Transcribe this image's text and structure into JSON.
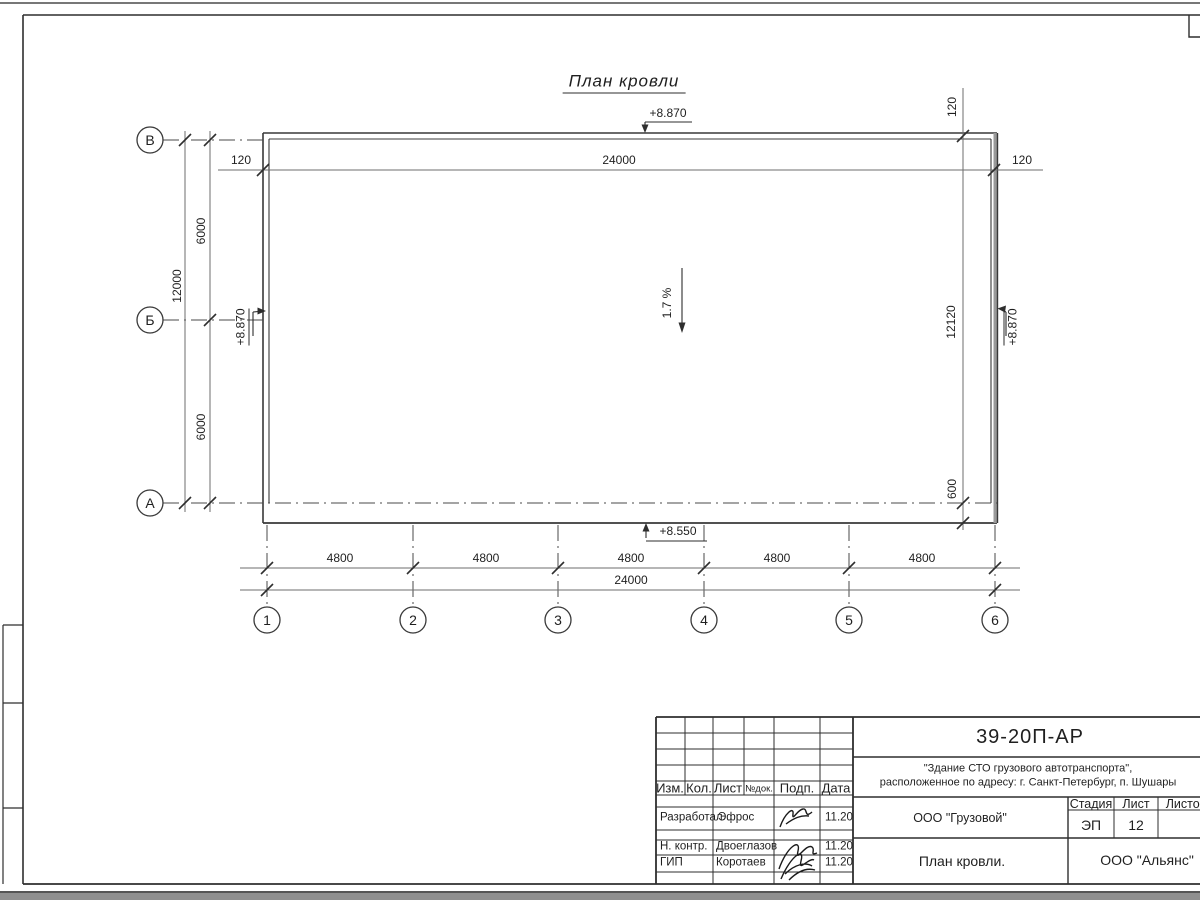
{
  "drawing": {
    "title": "План кровли",
    "slope": "1.7 %",
    "elevations": {
      "top": "+8.870",
      "left": "+8.870",
      "right": "+8.870",
      "bottom": "+8.550"
    },
    "dimensions": {
      "top_offset_left": "120",
      "top_total": "24000",
      "top_offset_right": "120",
      "top_right_vertical": "120",
      "left_span_upper": "6000",
      "left_span_lower": "6000",
      "left_total": "12000",
      "right_total": "12120",
      "right_overhang": "600",
      "bottom_segments": [
        "4800",
        "4800",
        "4800",
        "4800",
        "4800"
      ],
      "bottom_total": "24000"
    },
    "row_axes": [
      "В",
      "Б",
      "А"
    ],
    "col_axes": [
      "1",
      "2",
      "3",
      "4",
      "5",
      "6"
    ]
  },
  "title_block": {
    "doc_number": "39-20П-АР",
    "project_name_line1": "\"Здание СТО грузового автотранспорта\",",
    "project_name_line2": "расположенное по адресу: г. Санкт-Петербург, п. Шушары",
    "revision_headers": [
      "Изм.",
      "Кол.",
      "Лист",
      "№док.",
      "Подп.",
      "Дата"
    ],
    "signature_rows": [
      {
        "role": "Разработал",
        "name": "Эфрос",
        "date": "11.20"
      },
      {
        "role": "Н. контр.",
        "name": "Двоеглазов",
        "date": "11.20"
      },
      {
        "role": "ГИП",
        "name": "Коротаев",
        "date": "11.20"
      }
    ],
    "client": "ООО \"Грузовой\"",
    "stage_label": "Стадия",
    "sheet_label": "Лист",
    "sheets_label": "Листов",
    "stage_value": "ЭП",
    "sheet_value": "12",
    "sheet_title": "План кровли.",
    "company": "ООО \"Альянс\""
  }
}
